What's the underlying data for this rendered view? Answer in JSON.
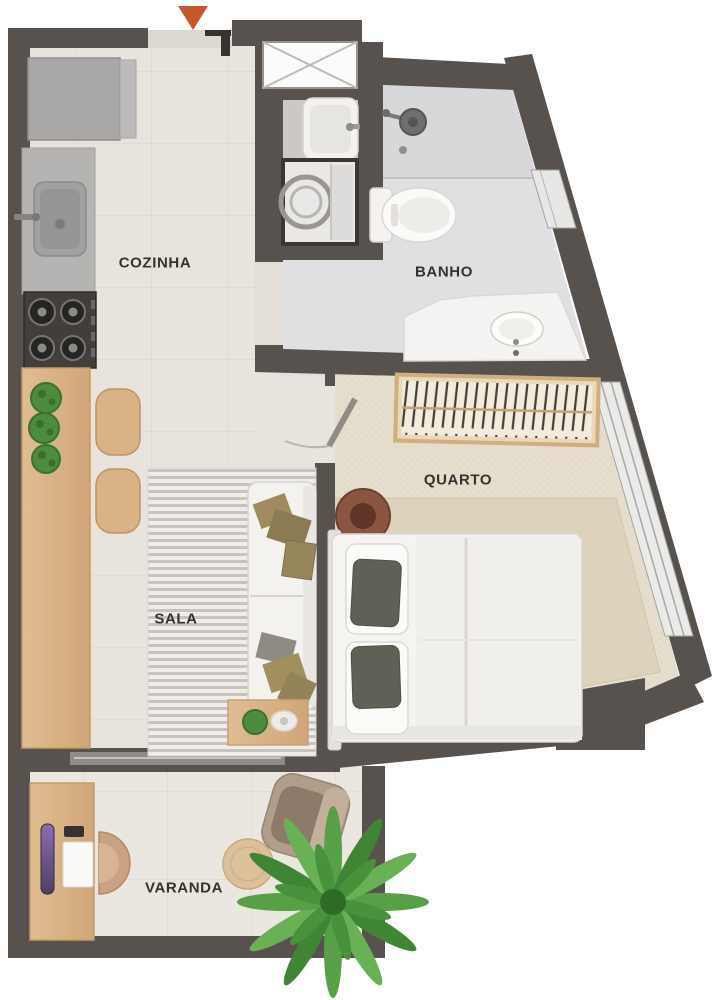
{
  "floor_plan": {
    "type": "apartment-floor-plan",
    "rooms": [
      {
        "id": "cozinha",
        "label": "COZINHA",
        "furniture": [
          "refrigerator",
          "counter-sink",
          "cooktop-4-burner",
          "wood-island-counter",
          "herb-plants",
          "bar-stool",
          "bar-stool"
        ]
      },
      {
        "id": "banho",
        "label": "BANHO",
        "furniture": [
          "shower",
          "toilet",
          "vanity-sink"
        ]
      },
      {
        "id": "quarto",
        "label": "QUARTO",
        "furniture": [
          "open-wardrobe",
          "double-bed",
          "round-side-table",
          "area-rug"
        ]
      },
      {
        "id": "sala",
        "label": "SALA",
        "furniture": [
          "striped-rug",
          "sofa",
          "throw-pillows",
          "coffee-table"
        ]
      },
      {
        "id": "varanda",
        "label": "VARANDA",
        "furniture": [
          "desk",
          "monitor",
          "notebook",
          "office-chair",
          "armchair",
          "pouf",
          "potted-palm"
        ]
      }
    ],
    "service_areas": [
      {
        "id": "laundry",
        "furniture": [
          "laundry-sink",
          "washing-machine"
        ]
      },
      {
        "id": "shaft",
        "symbol": "crossed-box"
      }
    ],
    "entrance": {
      "marker": "orange-triangle",
      "color": "#c4582b",
      "position": "top"
    },
    "colors": {
      "wall": "#57524e",
      "floor_main": "#e8e3dc",
      "floor_bath": "#e0e0e2",
      "floor_laundry": "#cbc8c5",
      "floor_quarto": "#e5decd",
      "rug_quarto": "#ddd2bb",
      "floor_varanda": "#eae6e0",
      "wood": "#d8b387",
      "plant_green": "#4c8c3c",
      "label_text": "#35322e",
      "entrance_arrow": "#c4582b"
    }
  }
}
